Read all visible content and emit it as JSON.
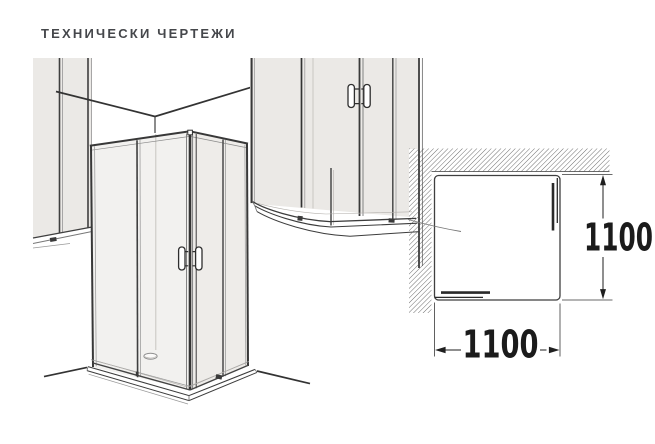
{
  "title": {
    "text": "ТЕХНИЧЕСКИ ЧЕРТЕЖИ"
  },
  "plan_view": {
    "width_label": "1100",
    "depth_label": "1100"
  },
  "colors": {
    "background": "#ffffff",
    "title_text": "#45474b",
    "wall_fill": "#ebe9e6",
    "glass_fill": "#f2f1ef",
    "glass_fill_shaded": "#eeece9",
    "tray_fill": "#ffffff",
    "hatch_line": "#4a4a4a",
    "dimension": "#1b1b1b"
  }
}
